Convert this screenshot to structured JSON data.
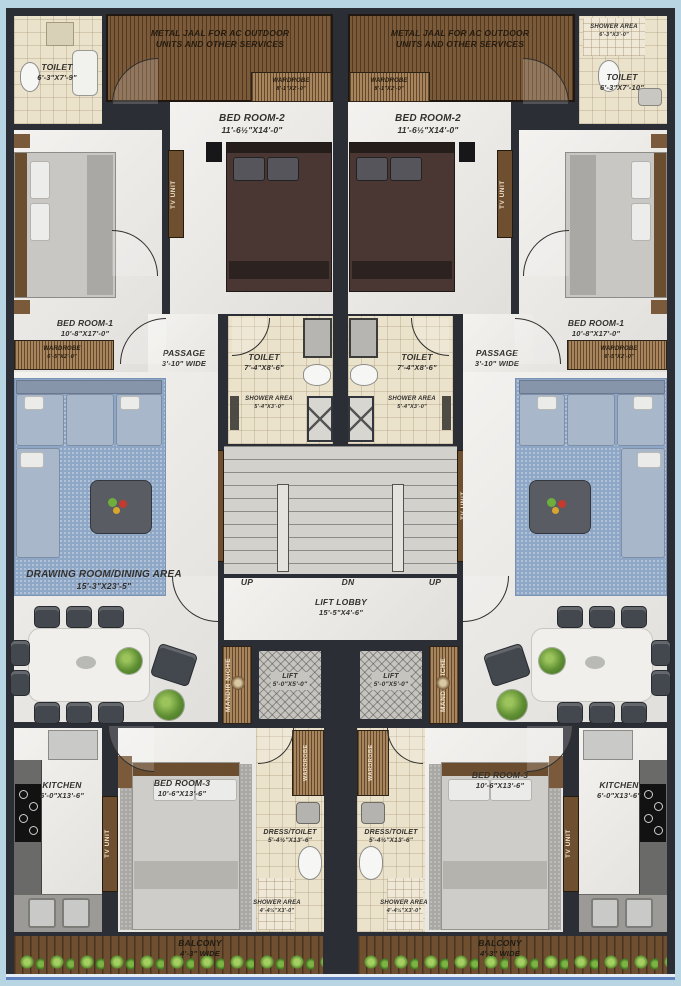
{
  "labels": {
    "metal_jaal_1": "METAL JAAL FOR AC OUTDOOR",
    "metal_jaal_2": "UNITS AND OTHER SERVICES",
    "up": "UP",
    "dn": "DN",
    "tv_unit": "TV UNIT",
    "mandir_niche": "MANDIR NICHE",
    "wardrobe": "WARDROBE"
  },
  "rooms": {
    "toilet_tl": {
      "name": "TOILET",
      "dims": "6'-3\"X7'-9\""
    },
    "toilet_tr": {
      "name": "TOILET",
      "dims": "6'-3\"X7'-10\""
    },
    "shower_tr": {
      "name": "SHOWER AREA",
      "dims": "6'-3\"X3'-0\""
    },
    "bedroom2": {
      "name": "BED ROOM-2",
      "dims": "11'-6½\"X14'-0\""
    },
    "bedroom1": {
      "name": "BED ROOM-1",
      "dims": "10'-8\"X17'-0\""
    },
    "passage": {
      "name": "PASSAGE",
      "dims": "3'-10\" WIDE"
    },
    "toilet_mid": {
      "name": "TOILET",
      "dims": "7'-4\"X8'-6\""
    },
    "shower_mid": {
      "name": "SHOWER AREA",
      "dims": "5'-4\"X3'-0\""
    },
    "drawing": {
      "name": "DRAWING ROOM/DINING AREA",
      "dims": "15'-3\"X23'-5\""
    },
    "lift_lobby": {
      "name": "LIFT LOBBY",
      "dims": "15'-5\"X4'-6\""
    },
    "lift": {
      "name": "LIFT",
      "dims": "5'-0\"X5'-0\""
    },
    "kitchen": {
      "name": "KITCHEN",
      "dims": "6'-0\"X13'-6\""
    },
    "bedroom3": {
      "name": "BED ROOM-3",
      "dims": "10'-6\"X13'-6\""
    },
    "dress_toilet": {
      "name": "DRESS/TOILET",
      "dims": "5'-4½\"X13'-6\""
    },
    "shower_bottom": {
      "name": "SHOWER AREA",
      "dims": "4'-4½\"X3'-0\""
    },
    "balcony": {
      "name": "BALCONY",
      "dims": "4'-3\" WIDE"
    },
    "wardrobe_b1": {
      "name": "WARDROBE",
      "dims": "6'-5\"X2'-0\""
    },
    "wardrobe_b2": {
      "name": "WARDROBE",
      "dims": "8'-1\"X2'-0\""
    }
  },
  "colors": {
    "wall": "#2b2e34",
    "marble_floor": "#edebe7",
    "bath_tile": "#ebe2cc",
    "wood": "#7b5a39",
    "rug_blue": "#8fa7c7",
    "margin_blue": "#b7d5e3",
    "railing_blue": "#5f83c0"
  }
}
